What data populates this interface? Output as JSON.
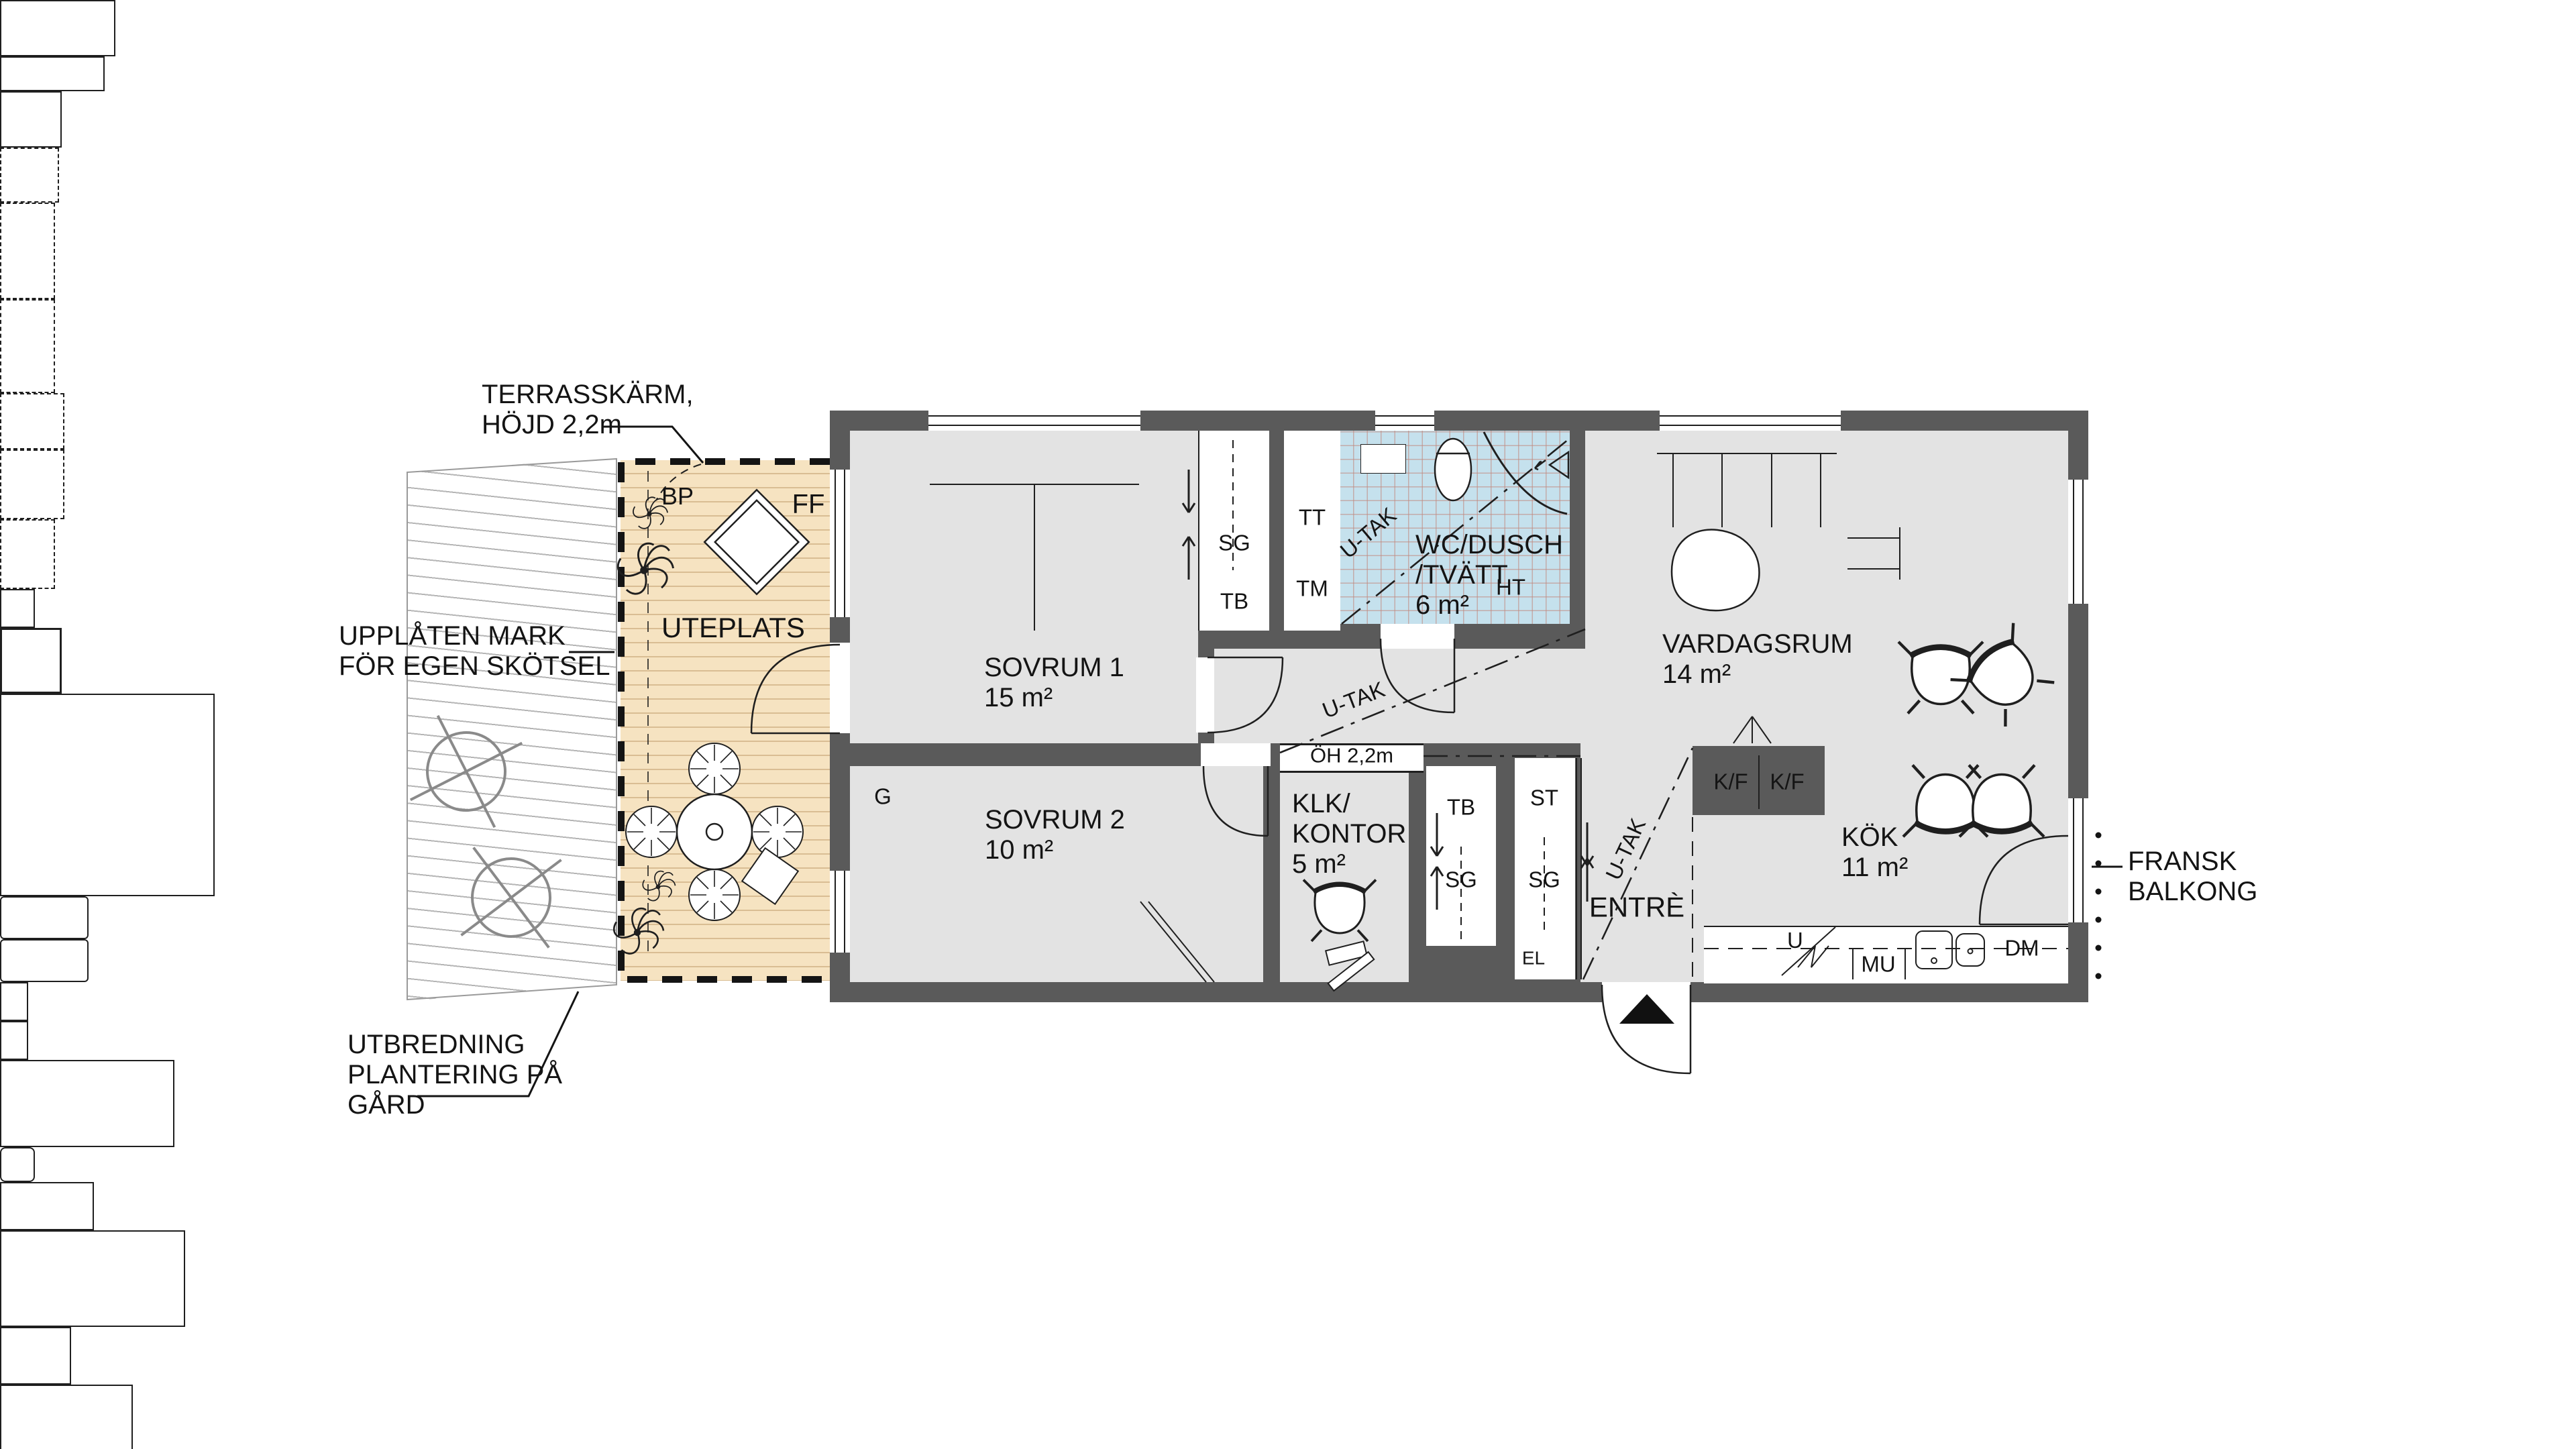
{
  "colors": {
    "wall": "#5a5a5a",
    "floor": "#e3e3e3",
    "bathroom_tile": "#c5e1ed",
    "terrace_wood": "#f6e3c1",
    "line": "#1f1f1f"
  },
  "annotations": {
    "terrace_screen_1": "TERRASSKÄRM,",
    "terrace_screen_2": "HÖJD 2,2m",
    "granted_land_1": "UPPLÅTEN MARK",
    "granted_land_2": "FÖR EGEN SKÖTSEL",
    "planting_1": "UTBREDNING",
    "planting_2": "PLANTERING PÅ",
    "planting_3": "GÅRD",
    "french_balcony_1": "FRANSK",
    "french_balcony_2": "BALKONG"
  },
  "terrace": {
    "label": "UTEPLATS",
    "bp": "BP",
    "ff": "FF"
  },
  "rooms": {
    "sovrum1_name": "SOVRUM 1",
    "sovrum1_area": "15 m²",
    "sovrum2_name": "SOVRUM 2",
    "sovrum2_area": "10 m²",
    "klk_name1": "KLK/",
    "klk_name2": "KONTOR",
    "klk_area": "5 m²",
    "wc_name1": "WC/DUSCH",
    "wc_name2": "/TVÄTT",
    "wc_area": "6 m²",
    "vardagsrum_name": "VARDAGSRUM",
    "vardagsrum_area": "14 m²",
    "kok_name": "KÖK",
    "kok_area": "11 m²",
    "entre_name": "ENTRÈ"
  },
  "fixtures": {
    "sg": "SG",
    "tb": "TB",
    "tt": "TT",
    "tm": "TM",
    "st": "ST",
    "el": "EL",
    "g": "G",
    "kf": "K/F",
    "u": "U",
    "mu": "MU",
    "dm": "DM",
    "ht": "HT",
    "u_tak": "U-TAK",
    "oh": "ÖH 2,2m"
  }
}
